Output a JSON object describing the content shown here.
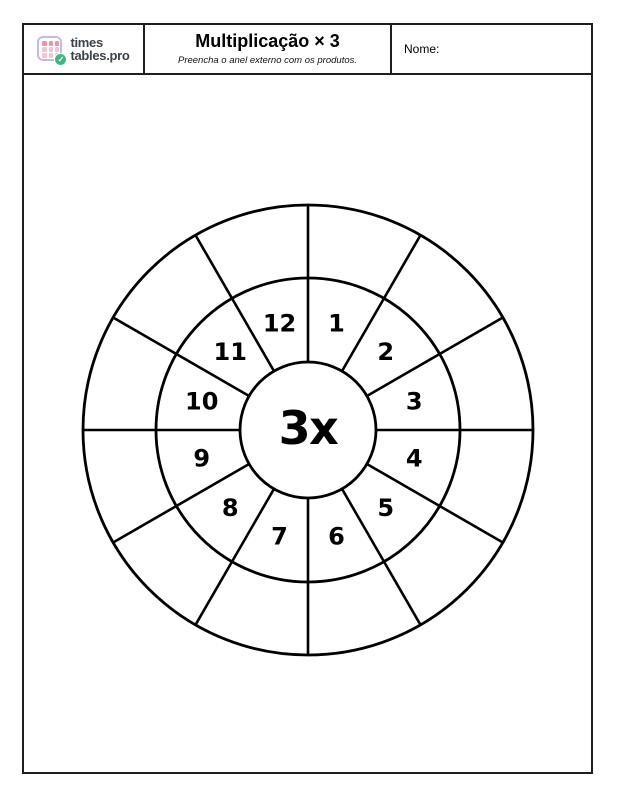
{
  "header": {
    "logo": {
      "line1": "times",
      "line2": "tables.pro",
      "check_glyph": "✓"
    },
    "title": "Multiplicação × 3",
    "subtitle": "Preencha o anel externo com os produtos.",
    "name_label": "Nome:"
  },
  "wheel": {
    "center_label": "3x",
    "numbers": [
      1,
      2,
      3,
      4,
      5,
      6,
      7,
      8,
      9,
      10,
      11,
      12
    ],
    "outer_ring_values": [
      "",
      "",
      "",
      "",
      "",
      "",
      "",
      "",
      "",
      "",
      "",
      ""
    ],
    "sectors": 12
  },
  "colors": {
    "ink": "#000000",
    "box_border": "#1f1f1f",
    "logo_text": "#3c434b",
    "logo_border": "#c9bbdf",
    "logo_dot_dark": "#ec92ad",
    "logo_dot_light": "#f6c3d4",
    "badge_green": "#43b581"
  }
}
